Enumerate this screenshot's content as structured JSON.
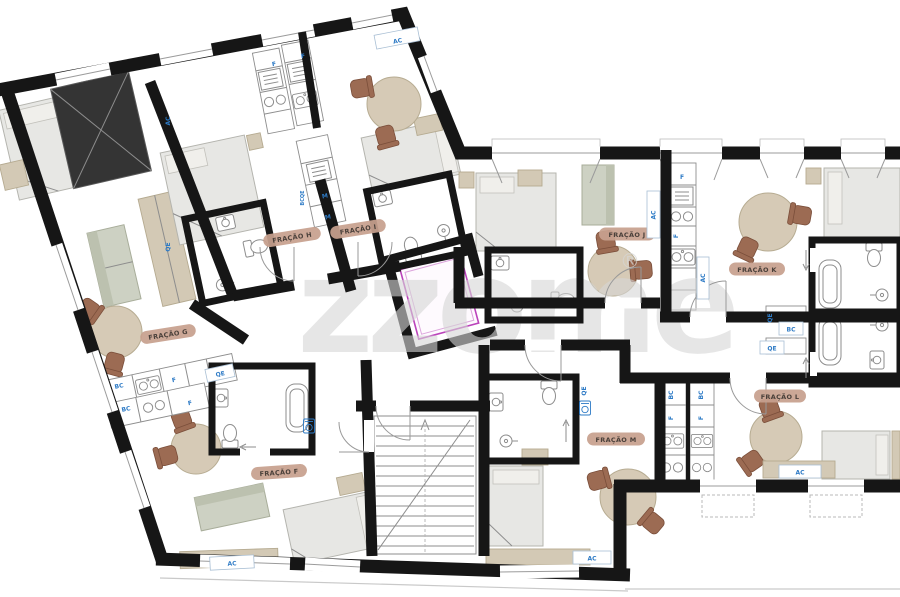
{
  "watermark": {
    "text": "zzome",
    "symbol": "®"
  },
  "rooms": [
    {
      "id": "fracao-f",
      "label": "FRAÇÃO F"
    },
    {
      "id": "fracao-g",
      "label": "FRAÇÃO G"
    },
    {
      "id": "fracao-h",
      "label": "FRAÇÃO H"
    },
    {
      "id": "fracao-i",
      "label": "FRAÇÃO I"
    },
    {
      "id": "fracao-j",
      "label": "FRAÇÃO J"
    },
    {
      "id": "fracao-k",
      "label": "FRAÇÃO K"
    },
    {
      "id": "fracao-l",
      "label": "FRAÇÃO L"
    },
    {
      "id": "fracao-m",
      "label": "FRAÇÃO M"
    }
  ],
  "codes": {
    "ac": "AC",
    "bc": "BC",
    "qe": "QE",
    "f": "F",
    "m": "M",
    "bcqe": "BCQE"
  },
  "colors": {
    "wall": "#161616",
    "furniture": "#e7e7e4",
    "wood": "#d3c9b5",
    "chair": "#9c6b53",
    "label_pill": "#c7a08e",
    "label_text": "#4a403a",
    "code_blue": "#2e7bc6",
    "elevator_magenta": "#bb43bb",
    "watermark_gray": "#d6d6d6"
  }
}
